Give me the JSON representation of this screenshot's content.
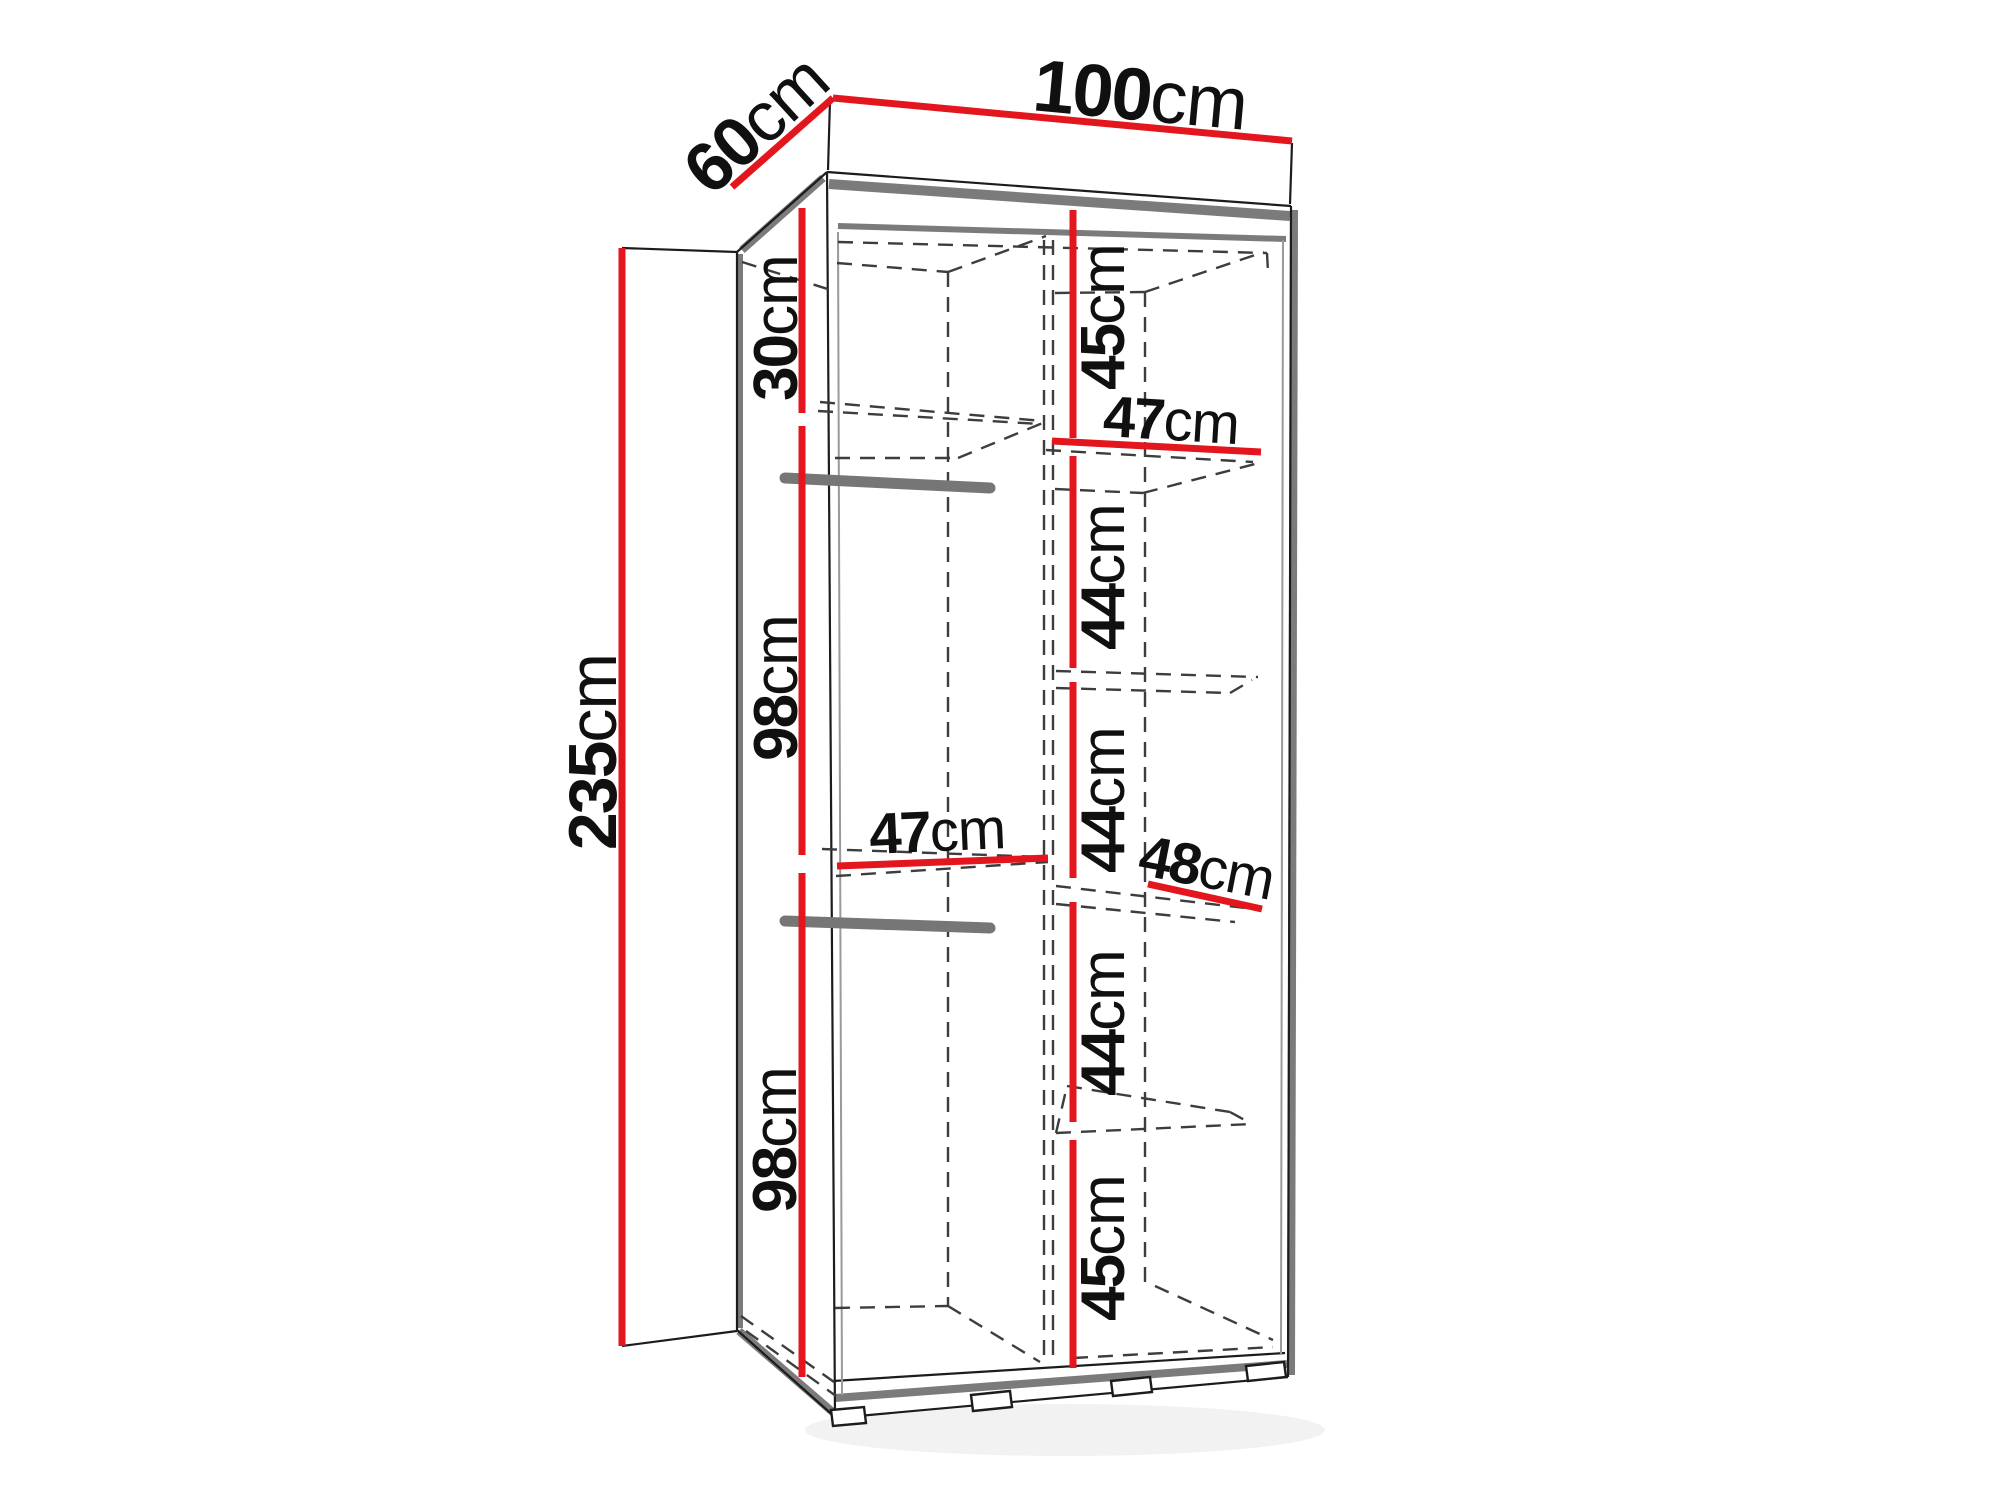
{
  "page": {
    "background": "#ffffff"
  },
  "diagram": {
    "type": "furniture-dimension-diagram",
    "subject": "two-section wardrobe with shelves and hanging rails",
    "unit": "cm",
    "colors": {
      "dimension_red": "#e3161e",
      "edge_gray": "#7b7b7b",
      "dash_gray": "#3d3d3d",
      "line_black": "#1c1c1c",
      "text": "#101010"
    },
    "overall": {
      "width": {
        "value": "100",
        "unit": "cm"
      },
      "depth": {
        "value": "60",
        "unit": "cm"
      },
      "height": {
        "value": "235",
        "unit": "cm"
      }
    },
    "left_section": {
      "top_compartment_height": {
        "value": "30",
        "unit": "cm"
      },
      "upper_hanging_height": {
        "value": "98",
        "unit": "cm"
      },
      "lower_hanging_height": {
        "value": "98",
        "unit": "cm"
      },
      "shelf_width": {
        "value": "47",
        "unit": "cm"
      },
      "hanging_rail_count": 2
    },
    "right_section": {
      "shelf_width_top": {
        "value": "47",
        "unit": "cm"
      },
      "shelf_width_middle": {
        "value": "48",
        "unit": "cm"
      },
      "compartment_heights": [
        {
          "value": "45",
          "unit": "cm"
        },
        {
          "value": "44",
          "unit": "cm"
        },
        {
          "value": "44",
          "unit": "cm"
        },
        {
          "value": "44",
          "unit": "cm"
        },
        {
          "value": "45",
          "unit": "cm"
        }
      ]
    }
  }
}
